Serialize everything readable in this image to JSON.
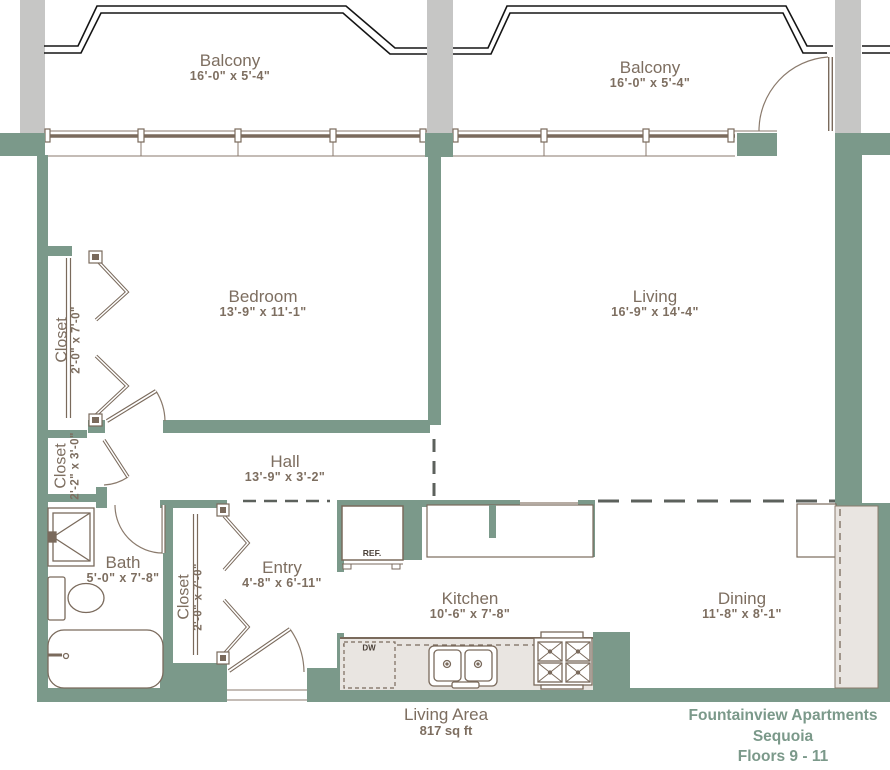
{
  "title_block": {
    "line1": "Fountainview Apartments",
    "line2": "Sequoia",
    "line3": "Floors 9 - 11"
  },
  "area": {
    "label": "Living Area",
    "value": "817 sq ft"
  },
  "rooms": {
    "balcony_left": {
      "label": "Balcony",
      "dims": "16'-0\" x 5'-4\""
    },
    "balcony_right": {
      "label": "Balcony",
      "dims": "16'-0\" x 5'-4\""
    },
    "bedroom": {
      "label": "Bedroom",
      "dims": "13'-9\" x 11'-1\""
    },
    "living": {
      "label": "Living",
      "dims": "16'-9\" x 14'-4\""
    },
    "hall": {
      "label": "Hall",
      "dims": "13'-9\" x 3'-2\""
    },
    "entry": {
      "label": "Entry",
      "dims": "4'-8\" x 6'-11\""
    },
    "bath": {
      "label": "Bath",
      "dims": "5'-0\" x 7'-8\""
    },
    "kitchen": {
      "label": "Kitchen",
      "dims": "10'-6\" x 7'-8\""
    },
    "dining": {
      "label": "Dining",
      "dims": "11'-8\" x 8'-1\""
    },
    "closet_bedroom": {
      "label": "Closet",
      "dims": "2'-0\" x 7'-0\""
    },
    "closet_hall": {
      "label": "Closet",
      "dims": "2'-2\" x 3'-0\""
    },
    "closet_entry": {
      "label": "Closet",
      "dims": "2'-0\" x 7'-0\""
    }
  },
  "appliances": {
    "refrigerator": "REF.",
    "dishwasher": "DW"
  },
  "colors": {
    "wall": "#7b998a",
    "column": "#c6c6c5",
    "line_thin": "#8a7a6c",
    "line_fixture": "#7a6a5c",
    "balcony_outline": "#151515",
    "dash_gray": "#5c615c",
    "counter_fill": "#e9e5e1",
    "label_text": "#7d6e60",
    "title_text": "#7b998a"
  }
}
